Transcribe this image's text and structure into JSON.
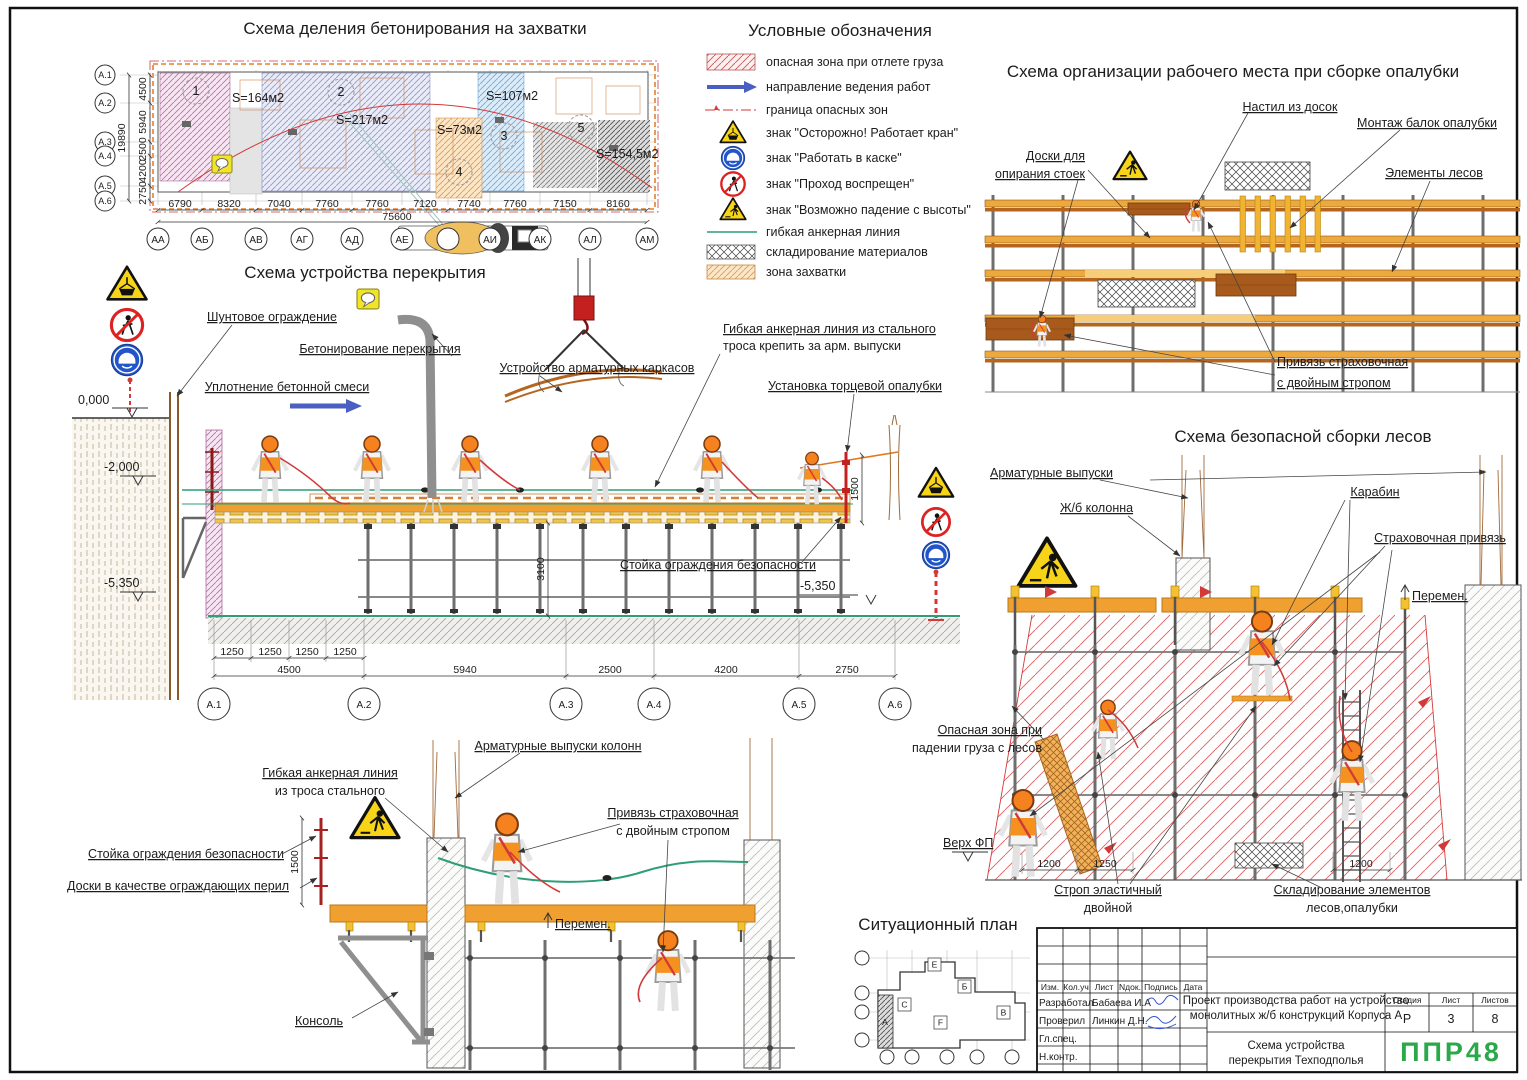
{
  "titles": {
    "plan": "Схема деления бетонирования на захватки",
    "legend": "Условные обозначения",
    "workplace": "Схема организации рабочего места при сборке опалубки",
    "slab": "Схема устройства перекрытия",
    "scaffold": "Схема безопасной сборки лесов",
    "situation": "Ситуационный план"
  },
  "plan": {
    "row_axes": [
      "А.1",
      "А.2",
      "А.3",
      "А.4",
      "А.5",
      "А.6"
    ],
    "row_dims": [
      "4500",
      "5940",
      "2500",
      "4200",
      "2750"
    ],
    "row_total": "19890",
    "col_axes": [
      "АА",
      "АБ",
      "АВ",
      "АГ",
      "АД",
      "АЕ",
      "",
      "АИ",
      "АК",
      "АЛ",
      "АМ"
    ],
    "col_dims": [
      "6790",
      "8320",
      "7040",
      "7760",
      "7760",
      "7120",
      "7740",
      "7760",
      "7150",
      "8160"
    ],
    "col_total": "75600",
    "zones": [
      {
        "num": "1",
        "area": "S=164м2"
      },
      {
        "num": "2",
        "area": "S=217м2"
      },
      {
        "num": "3",
        "area": "S=107м2"
      },
      {
        "num": "4",
        "area": "S=73м2"
      },
      {
        "num": "5",
        "area": "S=154,5м2"
      }
    ]
  },
  "legend": {
    "items": [
      "опасная зона при отлете груза",
      "направление ведения работ",
      "граница опасных зон",
      "знак \"Осторожно! Работает кран\"",
      "знак \"Работать в каске\"",
      "знак \"Проход воспрещен\"",
      "знак \"Возможно падение с высоты\"",
      "гибкая анкерная линия",
      "складирование материалов",
      "зона захватки"
    ]
  },
  "workplace": {
    "labels": {
      "deck": "Настил из досок",
      "beams": "Монтаж балок опалубки",
      "boards1": "Доски для",
      "boards2": "опирания стоек",
      "elements": "Элементы лесов",
      "harness1": "Привязь страховочная",
      "harness2": "с двойным стропом"
    }
  },
  "slab": {
    "labels": {
      "sheetpile": "Шунтовое ограждение",
      "concreting": "Бетонирование перекрытия",
      "compaction": "Уплотнение бетонной смеси",
      "rebar": "Устройство арматурных каркасов",
      "anchor1": "Гибкая анкерная линия из стального",
      "anchor2": "троса крепить за арм. выпуски",
      "endform": "Установка торцевой опалубки",
      "guard": "Стойка ограждения безопасности"
    },
    "levels": {
      "zero": "0,000",
      "minus2": "-2,000",
      "minus5": "-5,350",
      "minus5r": "-5,350"
    },
    "vdims": {
      "v1500": "1500",
      "v3100": "3100"
    },
    "dims_small": [
      "1250",
      "1250",
      "1250",
      "1250"
    ],
    "dims": [
      "4500",
      "5940",
      "2500",
      "4200",
      "2750"
    ],
    "axes": [
      "А.1",
      "А.2",
      "А.3",
      "А.4",
      "А.5",
      "А.6"
    ]
  },
  "scaffold": {
    "labels": {
      "rebar": "Арматурные выпуски",
      "column": "Ж/б колонна",
      "carabiner": "Карабин",
      "harness": "Страховочная привязь",
      "perem": "Перемен.",
      "danger1": "Опасная зона при",
      "danger2": "падении груза с лесов",
      "topfp": "Верх ФП",
      "sling1": "Строп эластичный",
      "sling2": "двойной",
      "storage1": "Складирование элементов",
      "storage2": "лесов,опалубки"
    },
    "dims": [
      "1200",
      "1250",
      "1200"
    ]
  },
  "lower": {
    "labels": {
      "anchor1": "Гибкая анкерная линия",
      "anchor2": "из троса стального",
      "rebar": "Арматурные выпуски колонн",
      "harness1": "Привязь страховочная",
      "harness2": "с двойным стропом",
      "guard": "Стойка ограждения безопасности",
      "boards": "Доски в качестве ограждающих перил",
      "console": "Консоль",
      "perem": "Перемен."
    },
    "vdim": "1500"
  },
  "situation": {
    "blocks": [
      "А",
      "С",
      "Е",
      "Б",
      "F",
      "В"
    ]
  },
  "titleblock": {
    "cols": [
      "Изм.",
      "Кол.уч",
      "Лист",
      "Nдок.",
      "Подпись",
      "Дата"
    ],
    "rows": [
      {
        "role": "Разработал",
        "name": "Бабаева И.А"
      },
      {
        "role": "Проверил",
        "name": "Линкин Д.Н."
      },
      {
        "role": "Гл.спец.",
        "name": ""
      },
      {
        "role": "Н.контр.",
        "name": ""
      }
    ],
    "project1": "Проект производства работ на устройство",
    "project2": "монолитных ж/б конструкций Корпуса А",
    "stage_h": "Стадия",
    "sheet_h": "Лист",
    "sheets_h": "Листов",
    "stage": "Р",
    "sheet": "3",
    "sheets": "8",
    "doc1": "Схема устройства",
    "doc2": "перекрытия Техподполья",
    "logo": "ППР48"
  }
}
